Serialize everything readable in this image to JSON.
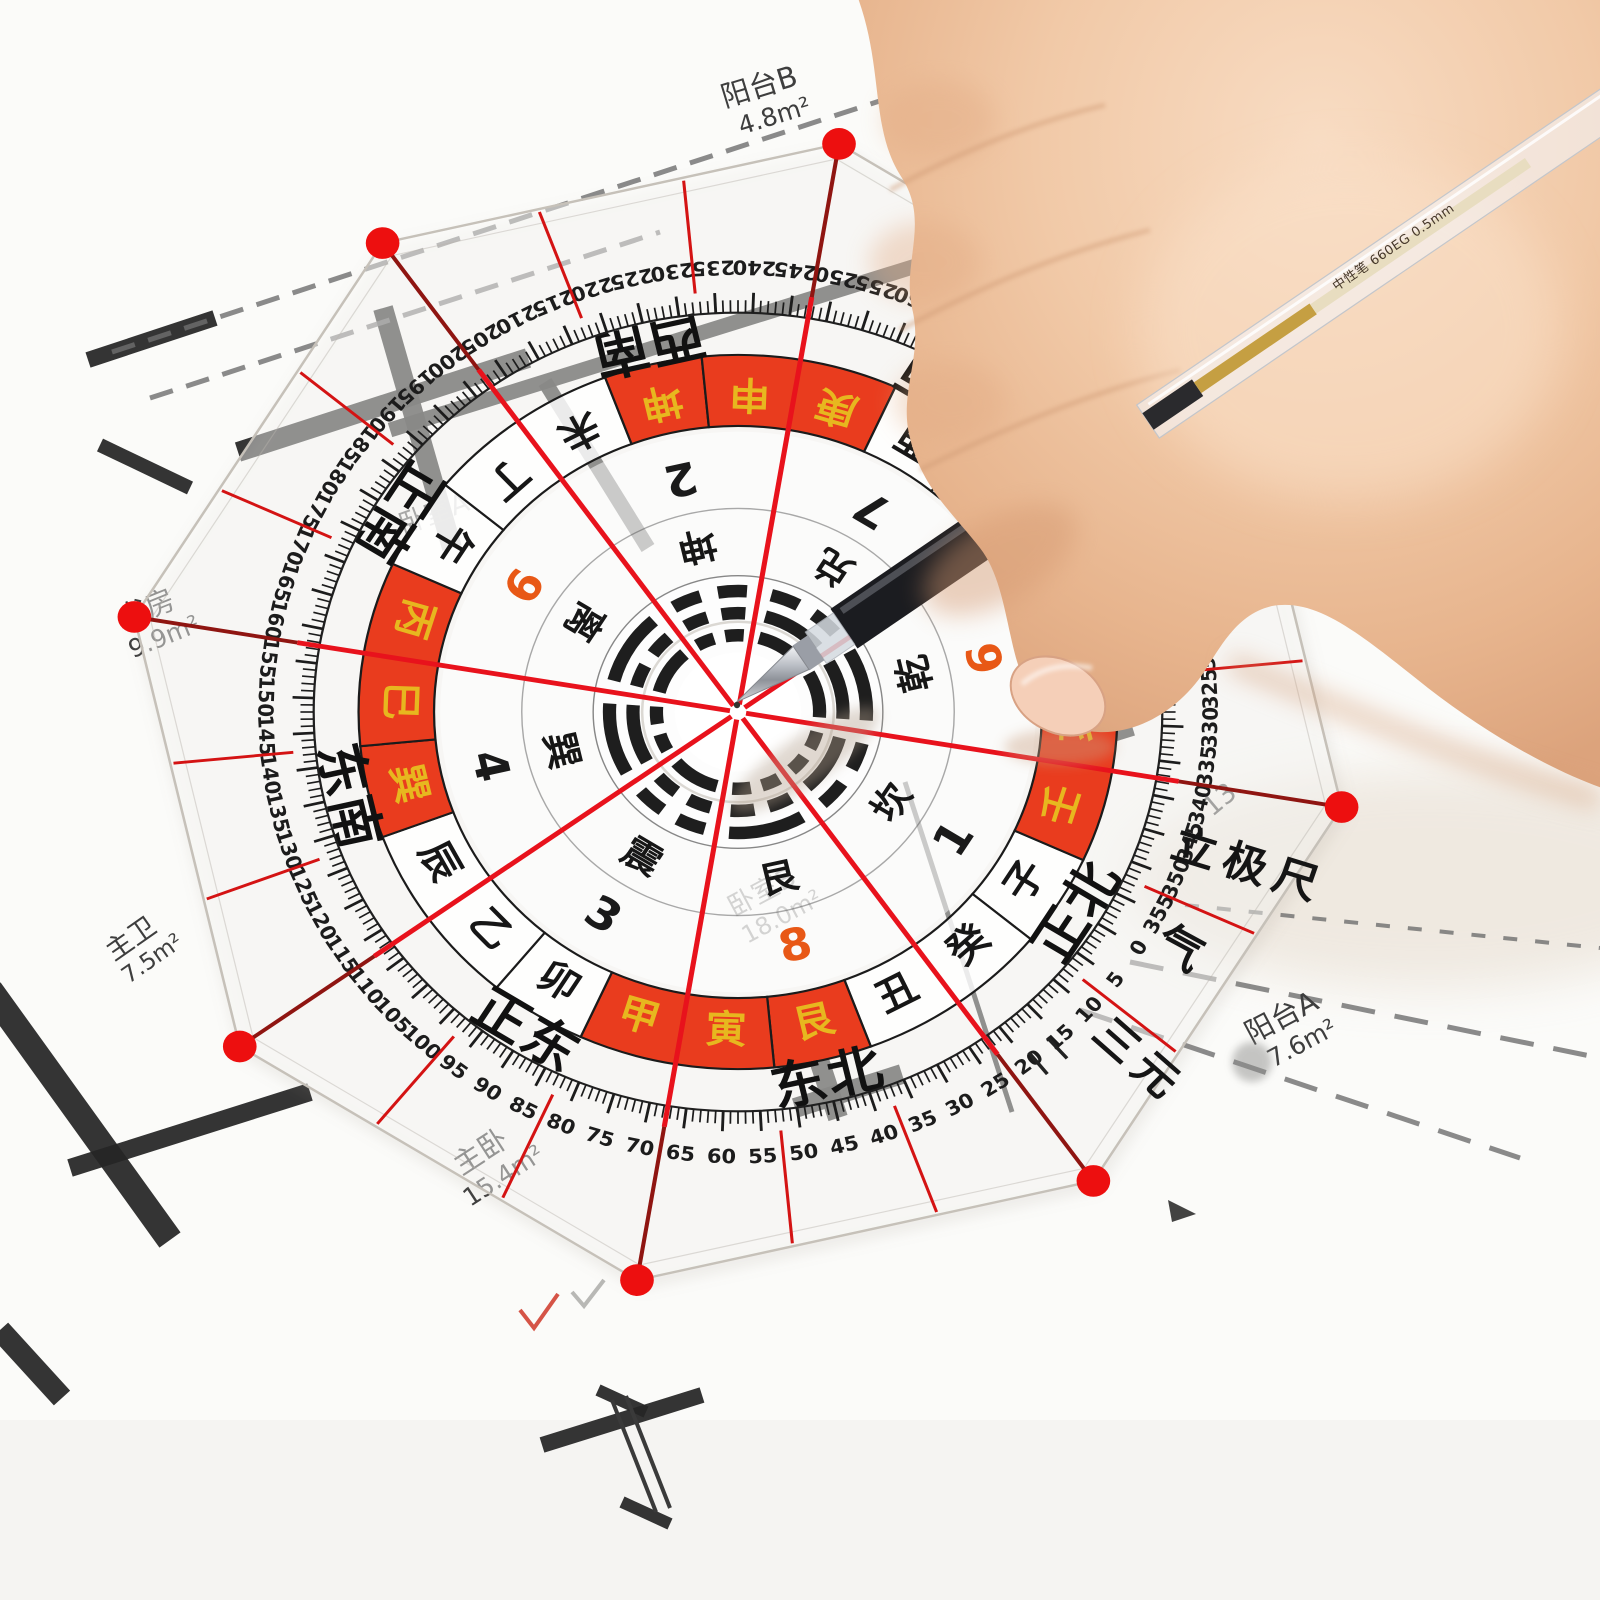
{
  "compass": {
    "rotation_deg": 122,
    "degree_labels": [
      "0",
      "5",
      "10",
      "15",
      "20",
      "25",
      "30",
      "35",
      "40",
      "45",
      "50",
      "55",
      "60",
      "65",
      "70",
      "75",
      "80",
      "85",
      "90",
      "95",
      "100",
      "105",
      "110",
      "115",
      "120",
      "125",
      "130",
      "135",
      "140",
      "145",
      "150",
      "155",
      "160",
      "165",
      "170",
      "175",
      "180",
      "185",
      "190",
      "195",
      "200",
      "205",
      "210",
      "215",
      "220",
      "225",
      "230",
      "235",
      "240",
      "245",
      "250",
      "255",
      "260",
      "265",
      "270",
      "275",
      "280",
      "285",
      "290",
      "295",
      "300",
      "305",
      "310",
      "315",
      "320",
      "325",
      "330",
      "335",
      "340",
      "345",
      "350",
      "355"
    ],
    "directions": [
      {
        "label": "正北",
        "deg": 0
      },
      {
        "label": "东北",
        "deg": 45
      },
      {
        "label": "正东",
        "deg": 90
      },
      {
        "label": "东南",
        "deg": 135
      },
      {
        "label": "正南",
        "deg": 180
      },
      {
        "label": "西南",
        "deg": 225
      },
      {
        "label": "正西",
        "deg": 270
      },
      {
        "label": "西北",
        "deg": 315
      }
    ],
    "mountains": [
      {
        "label": "子",
        "deg": 0,
        "red": false
      },
      {
        "label": "癸",
        "deg": 15,
        "red": false
      },
      {
        "label": "丑",
        "deg": 30,
        "red": false
      },
      {
        "label": "艮",
        "deg": 45,
        "red": true
      },
      {
        "label": "寅",
        "deg": 60,
        "red": true
      },
      {
        "label": "甲",
        "deg": 75,
        "red": true
      },
      {
        "label": "卯",
        "deg": 90,
        "red": false
      },
      {
        "label": "乙",
        "deg": 105,
        "red": false
      },
      {
        "label": "辰",
        "deg": 120,
        "red": false
      },
      {
        "label": "巽",
        "deg": 135,
        "red": true
      },
      {
        "label": "巳",
        "deg": 150,
        "red": true
      },
      {
        "label": "丙",
        "deg": 165,
        "red": true
      },
      {
        "label": "午",
        "deg": 180,
        "red": false
      },
      {
        "label": "丁",
        "deg": 195,
        "red": false
      },
      {
        "label": "未",
        "deg": 210,
        "red": false
      },
      {
        "label": "坤",
        "deg": 225,
        "red": true
      },
      {
        "label": "申",
        "deg": 240,
        "red": true
      },
      {
        "label": "庚",
        "deg": 255,
        "red": true
      },
      {
        "label": "酉",
        "deg": 270,
        "red": false
      },
      {
        "label": "辛",
        "deg": 285,
        "red": false
      },
      {
        "label": "戌",
        "deg": 300,
        "red": false
      },
      {
        "label": "乾",
        "deg": 315,
        "red": true
      },
      {
        "label": "亥",
        "deg": 330,
        "red": true
      },
      {
        "label": "壬",
        "deg": 345,
        "red": true
      }
    ],
    "palaces": [
      {
        "trigram": "坎",
        "star": "1",
        "deg": 0,
        "star_red": false,
        "lines": [
          0,
          1,
          0
        ]
      },
      {
        "trigram": "艮",
        "star": "8",
        "deg": 45,
        "star_red": true,
        "lines": [
          0,
          0,
          1
        ]
      },
      {
        "trigram": "震",
        "star": "3",
        "deg": 90,
        "star_red": false,
        "lines": [
          1,
          0,
          0
        ]
      },
      {
        "trigram": "巽",
        "star": "4",
        "deg": 135,
        "star_red": false,
        "lines": [
          0,
          1,
          1
        ]
      },
      {
        "trigram": "离",
        "star": "9",
        "deg": 180,
        "star_red": true,
        "lines": [
          1,
          0,
          1
        ]
      },
      {
        "trigram": "坤",
        "star": "2",
        "deg": 225,
        "star_red": false,
        "lines": [
          0,
          0,
          0
        ]
      },
      {
        "trigram": "兑",
        "star": "7",
        "deg": 270,
        "star_red": false,
        "lines": [
          1,
          1,
          0
        ]
      },
      {
        "trigram": "乾",
        "star": "6",
        "deg": 315,
        "star_red": true,
        "lines": [
          1,
          1,
          1
        ]
      }
    ],
    "brand": {
      "school": "三元",
      "name": "立极尺",
      "qi": "气"
    },
    "colors": {
      "line_red": "#e8121c",
      "cell_red": "#e93c1e",
      "gold": "#e7b71f",
      "star_red": "#e85816"
    }
  },
  "floor_plan": {
    "rooms": [
      {
        "name": "阳台B",
        "area": "4.8m²"
      },
      {
        "name": "卧室A",
        "area": ""
      },
      {
        "name": "书房",
        "area": "9.9m²"
      },
      {
        "name": "主卫",
        "area": "7.5m²"
      },
      {
        "name": "主卧",
        "area": "15.4m²"
      },
      {
        "name": "卧室B",
        "area": "18.0m²"
      },
      {
        "name": "阳台A",
        "area": "7.6m²"
      },
      {
        "name": "",
        "area": "13."
      }
    ]
  },
  "pen": {
    "barrel_text": "中性笔 660EG 0.5mm"
  }
}
